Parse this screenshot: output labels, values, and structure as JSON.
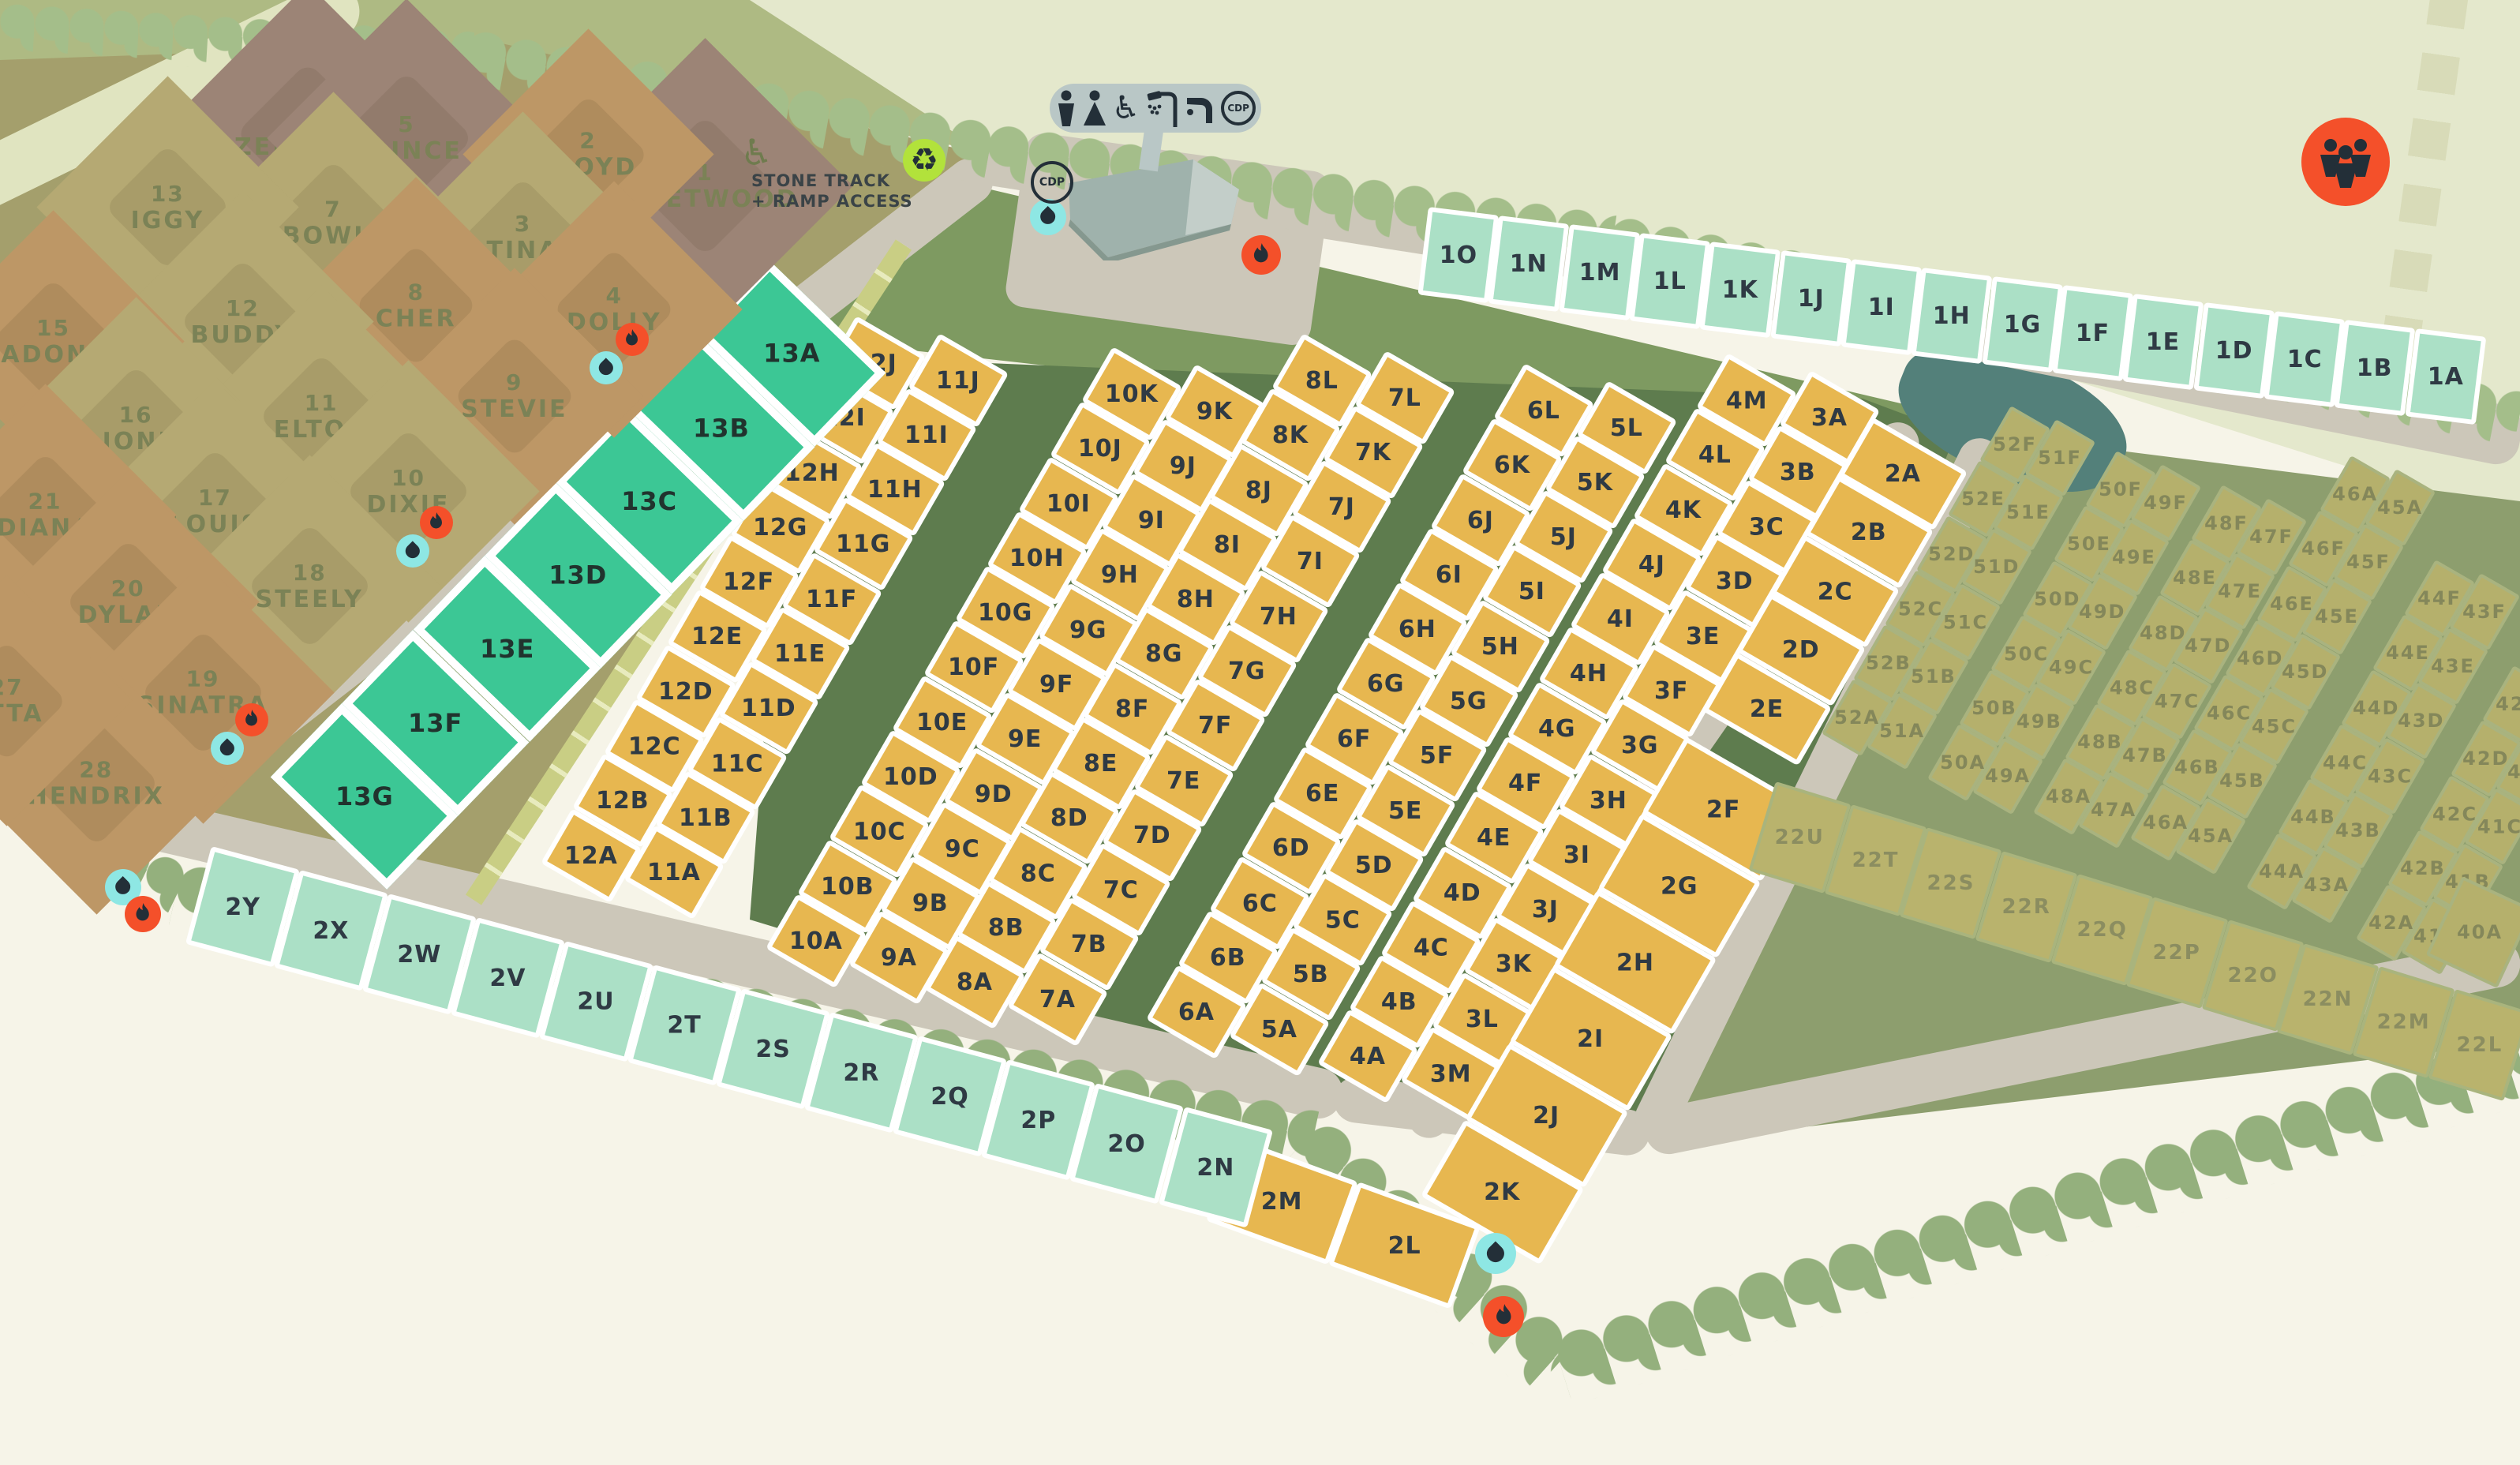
{
  "named_plots": [
    {
      "num": "6",
      "name": "ZEPPELIN",
      "shade": "purple"
    },
    {
      "num": "5",
      "name": "PRINCE",
      "shade": "purple"
    },
    {
      "num": "1",
      "name": "FLEETWOOD",
      "shade": "purple"
    },
    {
      "num": "2",
      "name": "FLOYD",
      "shade": "tan"
    },
    {
      "num": "3",
      "name": "TINA",
      "shade": "khaki"
    },
    {
      "num": "4",
      "name": "DOLLY",
      "shade": "tan"
    },
    {
      "num": "7",
      "name": "BOWIE",
      "shade": "khaki"
    },
    {
      "num": "8",
      "name": "CHER",
      "shade": "tan"
    },
    {
      "num": "9",
      "name": "STEVIE",
      "shade": "tan"
    },
    {
      "num": "13",
      "name": "IGGY",
      "shade": "khaki"
    },
    {
      "num": "12",
      "name": "BUDDY",
      "shade": "khaki"
    },
    {
      "num": "11",
      "name": "ELTON",
      "shade": "khaki"
    },
    {
      "num": "10",
      "name": "DIXIE",
      "shade": "khaki"
    },
    {
      "num": "15",
      "name": "MADONNA",
      "shade": "tan"
    },
    {
      "num": "16",
      "name": "JONI",
      "shade": "khaki"
    },
    {
      "num": "17",
      "name": "LOUIS",
      "shade": "khaki"
    },
    {
      "num": "18",
      "name": "STEELY",
      "shade": "khaki"
    },
    {
      "num": "21",
      "name": "DIANA",
      "shade": "tan"
    },
    {
      "num": "20",
      "name": "DYLAN",
      "shade": "tan"
    },
    {
      "num": "19",
      "name": "SINATRA",
      "shade": "tan"
    },
    {
      "num": "28",
      "name": "HENDRIX",
      "shade": "tan"
    },
    {
      "num": "27",
      "name": "ETTA",
      "shade": "tan"
    }
  ],
  "rows": {
    "row1": [
      "1O",
      "1N",
      "1M",
      "1L",
      "1K",
      "1J",
      "1I",
      "1H",
      "1G",
      "1F",
      "1E",
      "1D",
      "1C",
      "1B",
      "1A"
    ],
    "row2": [
      "2Y",
      "2X",
      "2W",
      "2V",
      "2U",
      "2T",
      "2S",
      "2R",
      "2Q",
      "2P",
      "2O",
      "2N"
    ],
    "teal13": [
      "13A",
      "13B",
      "13C",
      "13D",
      "13E",
      "13F",
      "13G"
    ],
    "row22": [
      "22U",
      "22T",
      "22S",
      "22R",
      "22Q",
      "22P",
      "22O",
      "22N",
      "22M",
      "22L"
    ],
    "pair2": [
      "2M",
      "2L"
    ]
  },
  "strips": {
    "y12": [
      "12J",
      "12I",
      "12H",
      "12G",
      "12F",
      "12E",
      "12D",
      "12C",
      "12B",
      "12A"
    ],
    "y11": [
      "11J",
      "11I",
      "11H",
      "11G",
      "11F",
      "11E",
      "11D",
      "11C",
      "11B",
      "11A"
    ],
    "y10": [
      "10K",
      "10J",
      "10I",
      "10H",
      "10G",
      "10F",
      "10E",
      "10D",
      "10C",
      "10B",
      "10A"
    ],
    "y9": [
      "9K",
      "9J",
      "9I",
      "9H",
      "9G",
      "9F",
      "9E",
      "9D",
      "9C",
      "9B",
      "9A"
    ],
    "y8": [
      "8L",
      "8K",
      "8J",
      "8I",
      "8H",
      "8G",
      "8F",
      "8E",
      "8D",
      "8C",
      "8B",
      "8A"
    ],
    "y7": [
      "7L",
      "7K",
      "7J",
      "7I",
      "7H",
      "7G",
      "7F",
      "7E",
      "7D",
      "7C",
      "7B",
      "7A"
    ],
    "y6": [
      "6L",
      "6K",
      "6J",
      "6I",
      "6H",
      "6G",
      "6F",
      "6E",
      "6D",
      "6C",
      "6B",
      "6A"
    ],
    "y5": [
      "5L",
      "5K",
      "5J",
      "5I",
      "5H",
      "5G",
      "5F",
      "5E",
      "5D",
      "5C",
      "5B",
      "5A"
    ],
    "y4": [
      "4M",
      "4L",
      "4K",
      "4J",
      "4I",
      "4H",
      "4G",
      "4F",
      "4E",
      "4D",
      "4C",
      "4B",
      "4A"
    ],
    "y3": [
      "3A",
      "3B",
      "3C",
      "3D",
      "3E",
      "3F",
      "3G",
      "3H",
      "3I",
      "3J",
      "3K",
      "3L",
      "3M"
    ],
    "c2u": [
      "2A",
      "2B",
      "2C",
      "2D",
      "2E"
    ],
    "c2l": [
      "2F",
      "2G",
      "2H",
      "2I",
      "2J",
      "2K"
    ],
    "o52": [
      "52F",
      "52E",
      "52D",
      "52C",
      "52B",
      "52A"
    ],
    "o51": [
      "51F",
      "51E",
      "51D",
      "51C",
      "51B",
      "51A"
    ],
    "o50": [
      "50F",
      "50E",
      "50D",
      "50C",
      "50B",
      "50A"
    ],
    "o49": [
      "49F",
      "49E",
      "49D",
      "49C",
      "49B",
      "49A"
    ],
    "o48": [
      "48F",
      "48E",
      "48D",
      "48C",
      "48B",
      "48A"
    ],
    "o47": [
      "47F",
      "47E",
      "47D",
      "47C",
      "47B",
      "47A"
    ],
    "o46": [
      "46A",
      "46F",
      "46E",
      "46D",
      "46C",
      "46B",
      "46A"
    ],
    "o45": [
      "45A",
      "45F",
      "45E",
      "45D",
      "45C",
      "45B",
      "45A"
    ],
    "o44": [
      "44F",
      "44E",
      "44D",
      "44C",
      "44B",
      "44A"
    ],
    "o43": [
      "43F",
      "43E",
      "43D",
      "43C",
      "43B",
      "43A"
    ],
    "o42": [
      "42E",
      "42D",
      "42C",
      "42B",
      "42A"
    ],
    "o41": [
      "",
      "41D",
      "41C",
      "41B",
      "41A"
    ],
    "o40": [
      "40A"
    ]
  },
  "labels": {
    "stone_track_line1": "STONE TRACK",
    "stone_track_line2": "+ RAMP ACCESS",
    "cdp": "CDP"
  },
  "facilities_legend": [
    "male",
    "female",
    "wheelchair-accessible",
    "shower",
    "drinking-water",
    "cdp"
  ],
  "colors": {
    "bg": "#f6f4e8",
    "top-band": "#e4e8cc",
    "hills": "#aeba83",
    "hill-path": "#e0e4c0",
    "brown-base": "#a49f6c",
    "plot-tan": "#bd9766",
    "plot-khaki": "#b5a973",
    "plot-purple": "#9c8476",
    "named-label": "#7b8256",
    "road": "#ccc7b9",
    "track-band": "#c9ce84",
    "track-tick": "#e8ebbe",
    "grass-dark": "#5e7c4e",
    "lawn": "#7e9a61",
    "hedge": "#94b07d",
    "tree": "#a4be8a",
    "pond": "#53807a",
    "olive-field": "#8d9e6e",
    "olive-plot": "#b5b06c",
    "olive-stroke": "#a9b37f",
    "olive-label": "#84875a",
    "mint": "#abe0c6",
    "teal": "#3cc795",
    "yellow": "#e7b750",
    "cell-label": "#2f3a44",
    "water-bg": "#8ee7e4",
    "fire-bg": "#f4502a",
    "recycle-bg": "#b2e23b",
    "icon-dark": "#232f38",
    "pill": "#b9c7c6",
    "building-main": "#9fb2ac",
    "building-face": "#c3cec9",
    "dash": "#d8dbb8"
  }
}
